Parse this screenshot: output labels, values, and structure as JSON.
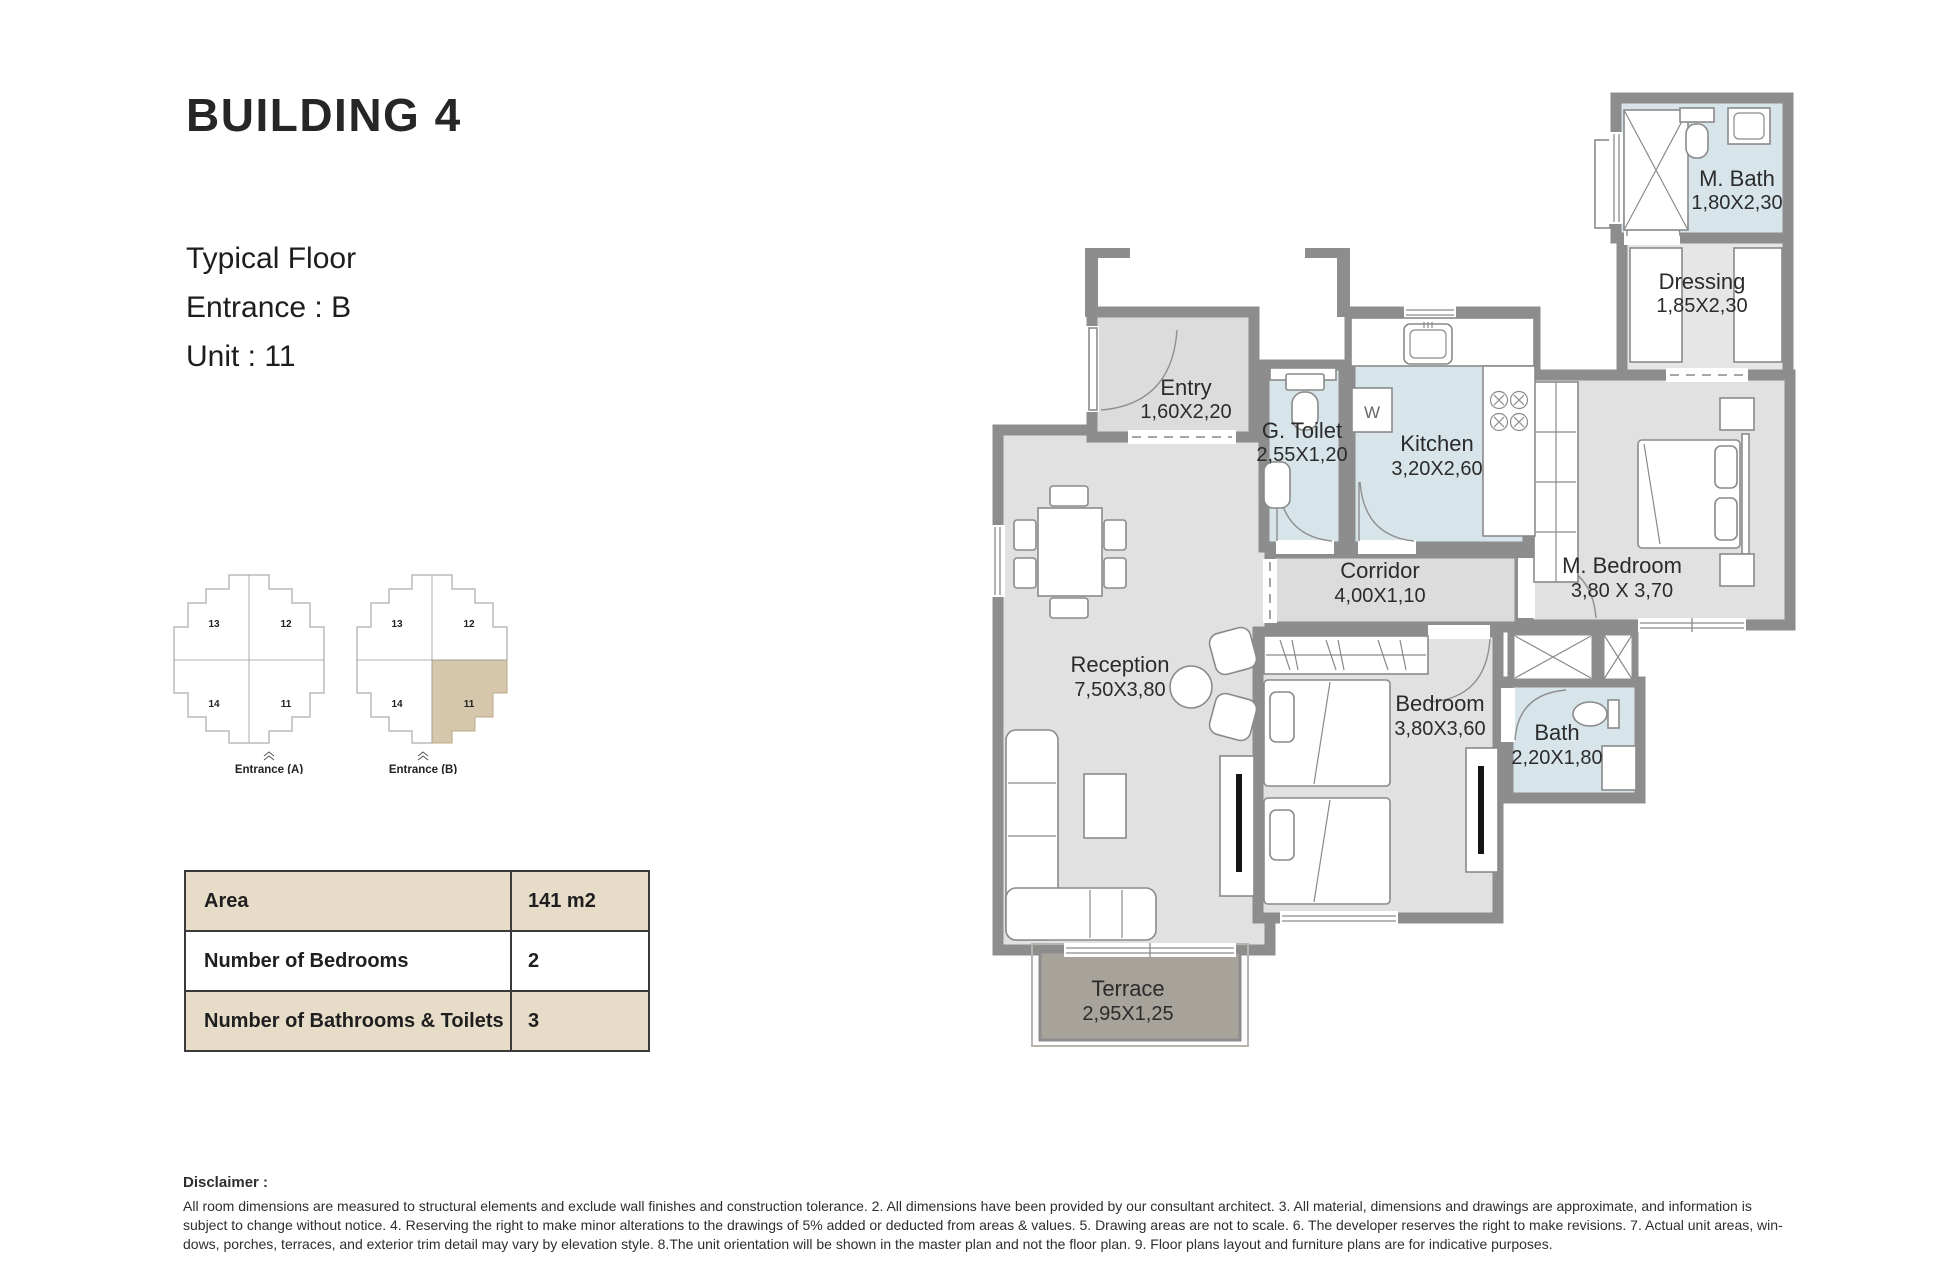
{
  "header": {
    "title": "BUILDING 4",
    "lines": [
      "Typical Floor",
      "Entrance : B",
      "Unit : 11"
    ]
  },
  "minimap": {
    "blocks": [
      {
        "caption": "Entrance (A)",
        "units": [
          "13",
          "12",
          "14",
          "11"
        ],
        "highlighted_unit": ""
      },
      {
        "caption": "Entrance (B)",
        "units": [
          "13",
          "12",
          "14",
          "11"
        ],
        "highlighted_unit": "11"
      }
    ]
  },
  "info_table": {
    "rows": [
      {
        "label": "Area",
        "value": "141 m2"
      },
      {
        "label": "Number of Bedrooms",
        "value": "2"
      },
      {
        "label": "Number of Bathrooms & Toilets",
        "value": "3"
      }
    ]
  },
  "floor_plan": {
    "washer_label": "W",
    "rooms": [
      {
        "name": "Entry",
        "dims": "1,60X2,20"
      },
      {
        "name": "G. Toilet",
        "dims": "2,55X1,20"
      },
      {
        "name": "Kitchen",
        "dims": "3,20X2,60"
      },
      {
        "name": "M. Bath",
        "dims": "1,80X2,30"
      },
      {
        "name": "Dressing",
        "dims": "1,85X2,30"
      },
      {
        "name": "Corridor",
        "dims": "4,00X1,10"
      },
      {
        "name": "M. Bedroom",
        "dims": "3,80 X 3,70"
      },
      {
        "name": "Reception",
        "dims": "7,50X3,80"
      },
      {
        "name": "Bedroom",
        "dims": "3,80X3,60"
      },
      {
        "name": "Bath",
        "dims": "2,20X1,80"
      },
      {
        "name": "Terrace",
        "dims": "2,95X1,25"
      }
    ]
  },
  "disclaimer": {
    "heading": "Disclaimer :",
    "lines": [
      "All room dimensions are measured to structural elements and exclude wall finishes and construction tolerance. 2. All dimensions have been provided by our consultant architect. 3. All material, dimensions and drawings are approximate, and information is",
      "subject to change without notice. 4. Reserving the right to make minor alterations to the drawings of 5% added or deducted from areas & values. 5. Drawing areas are not to scale. 6. The developer reserves the right to make revisions. 7. Actual unit areas, win-",
      "dows, porches, terraces, and exterior trim detail may vary by elevation style. 8.The unit orientation will be shown in the master plan and not the floor plan. 9. Floor plans layout and furniture plans are for indicative purposes."
    ]
  },
  "colors": {
    "accent_tan": "#e7dcc8",
    "highlight_tan": "#d6c6ab",
    "wall_gray": "#8d8d8d",
    "floor_gray": "#e1e1e1",
    "wet_room_blue": "#d7e5eb",
    "terrace_gray": "#a7a39b"
  }
}
